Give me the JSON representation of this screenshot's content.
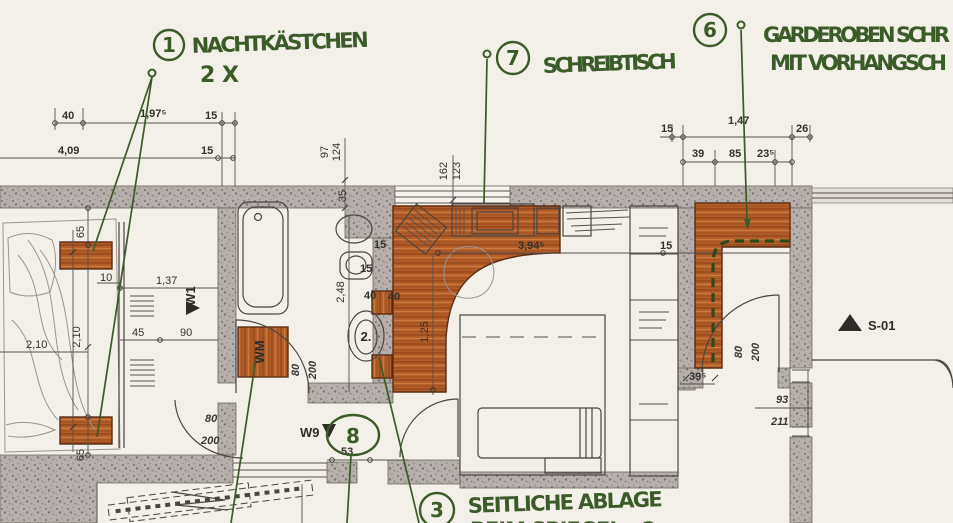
{
  "callouts": {
    "c1": {
      "num": "1",
      "line1": "NACHTKÄSTCHEN",
      "line2": "2X"
    },
    "c7": {
      "num": "7",
      "label": "SCHREIBTISCH"
    },
    "c6": {
      "num": "6",
      "line1": "GARDEROBEN SCHR",
      "line2": "MIT VORHANGSCH"
    },
    "c3": {
      "num": "3",
      "line1": "SEITLICHE ABLAGE",
      "line2": "BEIM SPIEGEL - 2x"
    },
    "c8": {
      "num": "8"
    }
  },
  "markers": {
    "w1": "W1",
    "w9": "W9",
    "s01": "S-01",
    "wm": "WM",
    "pos2": "2."
  },
  "dims": {
    "tl": {
      "a": "40",
      "b": "1,97⁵",
      "c": "15",
      "d": "4,09",
      "e": "15"
    },
    "tm": {
      "a": "97",
      "b": "124",
      "c": "162",
      "d": "123",
      "e": "35"
    },
    "tr": {
      "a": "15",
      "b": "1,47",
      "c": "26",
      "d": "39",
      "e": "85",
      "f": "23⁵"
    },
    "bed": {
      "a": "65",
      "b": "10",
      "c": "1,37",
      "d": "2,10",
      "e": "2,10",
      "f": "45",
      "g": "90",
      "h": "65"
    },
    "bath": {
      "a": "2,48",
      "b": "15",
      "c": "15",
      "d": "40",
      "e": "80",
      "f": "200"
    },
    "desk": {
      "a": "3,94⁵",
      "b": "1,25",
      "c": "15",
      "d": "40"
    },
    "vest": {
      "a": "80",
      "b": "200",
      "c": "53"
    },
    "corr": {
      "a": "39⁵",
      "b": "80",
      "c": "200"
    },
    "right": {
      "a": "93",
      "b": "211"
    }
  },
  "colors": {
    "ink_green": "#3b5b28",
    "wood": "#b25c28",
    "wall": "#b6afac",
    "paper": "#f3efe9"
  }
}
